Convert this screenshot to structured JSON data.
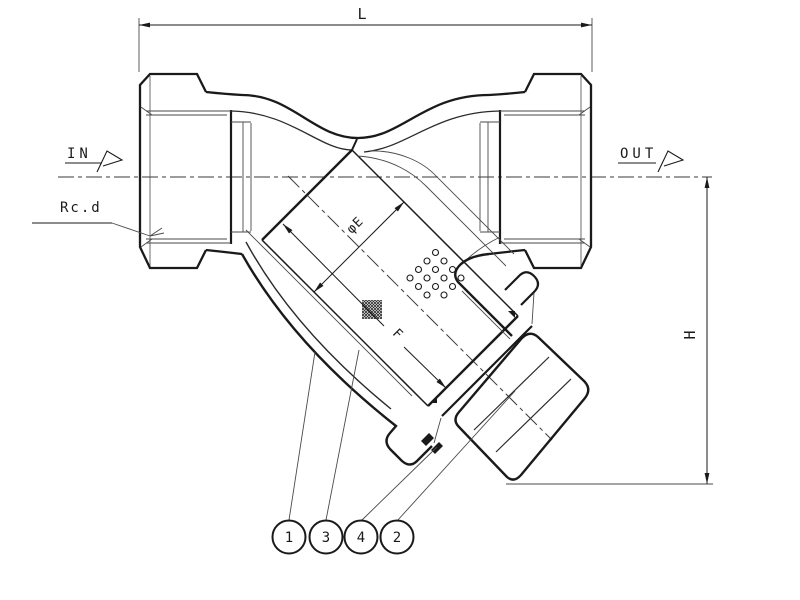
{
  "drawing": {
    "dims": {
      "length_label": "L",
      "height_label": "H",
      "screen_diameter_label": "φE",
      "screen_length_label": "F"
    },
    "flow": {
      "in_label": "IN",
      "out_label": "OUT"
    },
    "thread_label": "Rc.d",
    "balloons": [
      {
        "number": "1"
      },
      {
        "number": "3"
      },
      {
        "number": "4"
      },
      {
        "number": "2"
      }
    ],
    "colors": {
      "line": "#1a1a1a",
      "thin_line": "#4a4a4a",
      "centerline": "#3a3a3a",
      "balloon_digit": "#2e5f86",
      "background": "#ffffff"
    }
  }
}
